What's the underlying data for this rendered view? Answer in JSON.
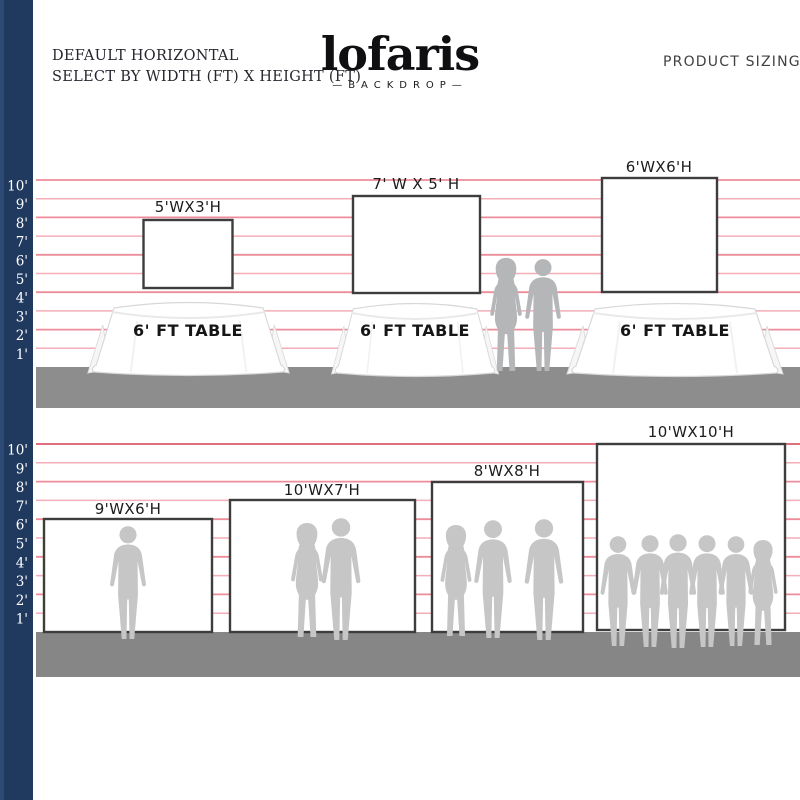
{
  "header": {
    "left_line1": "DEFAULT HORIZONTAL",
    "left_line2": "SELECT BY WIDTH (FT) X HEIGHT (FT)",
    "logo_name": "lofaris",
    "logo_sub": "—BACKDROP—",
    "right_title": "PRODUCT SIZING"
  },
  "ruler": {
    "marks": [
      "10'",
      "9'",
      "8'",
      "7'",
      "6'",
      "5'",
      "4'",
      "3'",
      "2'",
      "1'"
    ]
  },
  "rows": [
    {
      "backdrops": [
        {
          "label": "5'WX3'H"
        },
        {
          "label": "7' W X 5' H"
        },
        {
          "label": "6'WX6'H"
        }
      ],
      "tables": [
        "6' FT TABLE",
        "6' FT TABLE",
        "6' FT TABLE"
      ]
    },
    {
      "backdrops": [
        {
          "label": "9'WX6'H"
        },
        {
          "label": "10'WX7'H"
        },
        {
          "label": "8'WX8'H"
        },
        {
          "label": "10'WX10'H"
        }
      ]
    }
  ],
  "colors": {
    "ruler_bar_navy": "#20395f",
    "guide_line_pink": "#ec8d99",
    "guide_line_pink_light": "#f3aeb8",
    "floor_gray": "#8d8d8d",
    "silhouette_gray_row1": "#b5b6b8",
    "silhouette_gray_row2": "#c6c6c6",
    "backdrop_border": "#3d3d3d"
  }
}
